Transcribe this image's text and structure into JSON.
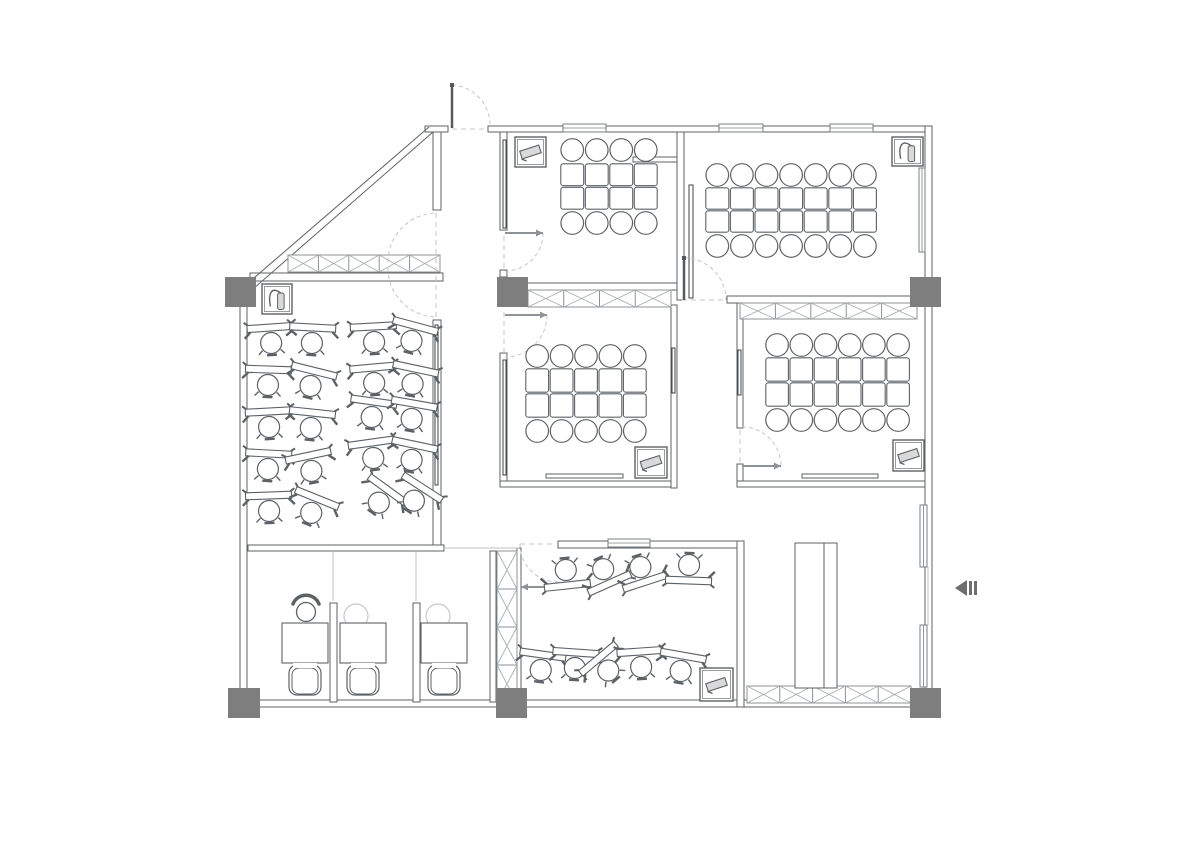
{
  "meta": {
    "drawing_type": "office-floor-plan",
    "canvas_w": 1200,
    "canvas_h": 848,
    "bg": "#ffffff"
  },
  "palette": {
    "wall": "#5d6166",
    "wall_fill": "#ffffff",
    "glass": "#3c4043",
    "window": "#7a7f84",
    "light": "#c2c2c2",
    "dash": "#c6c6c6",
    "leaf_light": "#8f9398",
    "leaf_dark": "#55585c",
    "casework": "#8d9196",
    "casework_x": "#a8adb2",
    "column": "#7e7e7e",
    "furniture": "#5d6166",
    "soft": "#c9c9c9",
    "arrow": "#6e6e6e",
    "equip_fill": "#d9d9d9"
  },
  "rooms_summary": [
    {
      "name": "meeting-room-top-left",
      "table": "4x2",
      "seats": 8,
      "equipment": [
        "tv-box",
        "wall-shelf"
      ]
    },
    {
      "name": "meeting-room-top-right",
      "table": "7x2",
      "seats": 14,
      "equipment": [
        "fire-extinguisher-box"
      ]
    },
    {
      "name": "meeting-room-mid-left",
      "table": "5x2",
      "seats": 10,
      "equipment": [
        "tv-box",
        "whiteboard"
      ]
    },
    {
      "name": "meeting-room-mid-right",
      "table": "6x2",
      "seats": 12,
      "equipment": [
        "tv-box",
        "whiteboard"
      ]
    },
    {
      "name": "training-room",
      "desk_units": 20,
      "rows": 5,
      "cols": 4
    },
    {
      "name": "offices",
      "workstations": 3,
      "equipment": [
        "phone",
        "monitors"
      ]
    },
    {
      "name": "computer-room",
      "desk_units": 9,
      "equipment": [
        "projector-box"
      ]
    },
    {
      "name": "vestibule",
      "equipment": [
        "casework",
        "fire-extinguisher-box"
      ]
    }
  ],
  "plan": {
    "walls": [
      [
        425,
        126,
        23,
        6
      ],
      [
        488,
        126,
        444,
        6
      ],
      [
        925,
        126,
        7,
        580
      ],
      [
        232,
        700,
        708,
        7
      ],
      [
        240,
        305,
        7,
        397
      ],
      [
        250,
        273,
        193,
        8
      ],
      [
        433,
        132,
        8,
        78
      ],
      [
        433,
        320,
        8,
        225
      ],
      [
        500,
        132,
        7,
        98
      ],
      [
        500,
        270,
        7,
        7
      ],
      [
        500,
        353,
        7,
        128
      ],
      [
        677,
        132,
        7,
        168
      ],
      [
        500,
        283,
        177,
        7
      ],
      [
        500,
        481,
        177,
        6
      ],
      [
        671,
        305,
        6,
        183
      ],
      [
        727,
        296,
        198,
        7
      ],
      [
        737,
        303,
        6,
        125
      ],
      [
        737,
        464,
        6,
        23
      ],
      [
        737,
        481,
        188,
        6
      ],
      [
        248,
        545,
        196,
        6
      ],
      [
        490,
        551,
        6,
        151
      ],
      [
        558,
        541,
        186,
        7
      ],
      [
        737,
        541,
        7,
        166
      ],
      [
        330,
        603,
        7,
        99
      ],
      [
        413,
        603,
        7,
        99
      ],
      [
        517,
        548,
        4,
        154
      ]
    ],
    "diagonals": [
      [
        247,
        284,
        429,
        127
      ],
      [
        253,
        289,
        433,
        132
      ]
    ],
    "glass": [
      [
        503,
        140,
        3,
        88
      ],
      [
        503,
        360,
        3,
        115
      ],
      [
        435,
        325,
        3,
        160
      ],
      [
        689,
        185,
        4,
        113
      ],
      [
        672,
        348,
        3,
        45
      ],
      [
        738,
        350,
        3,
        45
      ]
    ],
    "windows_h": [
      [
        563,
        124,
        43,
        8
      ],
      [
        719,
        124,
        44,
        8
      ],
      [
        830,
        124,
        43,
        8
      ],
      [
        608,
        539,
        42,
        8
      ]
    ],
    "windows_v": [
      [
        919,
        168,
        6,
        84
      ],
      [
        920,
        505,
        7,
        62
      ],
      [
        920,
        625,
        7,
        62
      ]
    ],
    "light_lines": [
      [
        333,
        551,
        333,
        601
      ],
      [
        416,
        551,
        416,
        601
      ],
      [
        444,
        548,
        519,
        548
      ],
      [
        928,
        567,
        928,
        625
      ]
    ],
    "casework": [
      [
        288,
        255,
        152,
        17,
        5,
        "h"
      ],
      [
        528,
        290,
        143,
        17,
        4,
        "h"
      ],
      [
        740,
        303,
        177,
        16,
        5,
        "h"
      ],
      [
        497,
        551,
        20,
        152,
        4,
        "v"
      ],
      [
        747,
        686,
        164,
        17,
        5,
        "h"
      ]
    ],
    "columns": [
      [
        225,
        277,
        31,
        30
      ],
      [
        497,
        277,
        31,
        30
      ],
      [
        910,
        277,
        31,
        30
      ],
      [
        228,
        688,
        32,
        30
      ],
      [
        496,
        688,
        31,
        30
      ],
      [
        910,
        688,
        31,
        30
      ]
    ],
    "whiteboards": [
      [
        546,
        474,
        77,
        4
      ],
      [
        802,
        474,
        76,
        4
      ],
      [
        633,
        157,
        44,
        5
      ]
    ],
    "dash_lines": [
      [
        436,
        213,
        436,
        318
      ],
      [
        504,
        236,
        504,
        268
      ],
      [
        504,
        312,
        504,
        352
      ],
      [
        682,
        300,
        727,
        300
      ],
      [
        520,
        544,
        556,
        544
      ],
      [
        740,
        430,
        740,
        462
      ],
      [
        452,
        129,
        488,
        129
      ]
    ],
    "door_arcs": [
      "M388 262 A49 49 0 0 1 437 213",
      "M388 268 A49 49 0 0 0 437 317",
      "M543 233 A38 38 0 0 1 505 271",
      "M547 315 A42 42 0 0 1 505 357",
      "M684 258 A42 42 0 0 1 726 300",
      "M742 427 A39 39 0 0 1 781 466",
      "M520 544 A38 38 0 0 0 558 582",
      "M452 85 A40 40 0 0 1 490 126"
    ],
    "door_leaves_light": [
      [
        505,
        233,
        543,
        233
      ],
      [
        505,
        315,
        547,
        315
      ],
      [
        742,
        466,
        781,
        466
      ],
      [
        558,
        587,
        521,
        587
      ]
    ],
    "door_leaves_dark": [
      [
        452,
        85,
        452,
        128
      ],
      [
        684,
        258,
        684,
        300
      ]
    ],
    "shaft": {
      "x": 795,
      "y": 543,
      "w": 42,
      "h": 145,
      "divider_x": 824
    },
    "tables": [
      {
        "x": 560,
        "y": 163,
        "cols": 4,
        "rows": 2,
        "cw": 24.5,
        "ch": 23.5,
        "chair_r": 11.3,
        "top_cy": 150,
        "bot_cy": 223
      },
      {
        "x": 705,
        "y": 187,
        "cols": 7,
        "rows": 2,
        "cw": 24.6,
        "ch": 23,
        "chair_r": 11.3,
        "top_cy": 175,
        "bot_cy": 246
      },
      {
        "x": 525,
        "y": 368,
        "cols": 5,
        "rows": 2,
        "cw": 24.4,
        "ch": 25,
        "chair_r": 11.3,
        "top_cy": 356,
        "bot_cy": 431
      },
      {
        "x": 765,
        "y": 357,
        "cols": 6,
        "rows": 2,
        "cw": 24.2,
        "ch": 25,
        "chair_r": 11.3,
        "top_cy": 345,
        "bot_cy": 420
      }
    ],
    "desks": [
      [
        271,
        341,
        -4,
        0
      ],
      [
        312,
        341,
        3,
        0
      ],
      [
        374,
        340,
        -3,
        0
      ],
      [
        412,
        339,
        15,
        0
      ],
      [
        268,
        383,
        2,
        0
      ],
      [
        311,
        384,
        14,
        0
      ],
      [
        374,
        381,
        -5,
        0
      ],
      [
        413,
        382,
        12,
        0
      ],
      [
        269,
        425,
        -3,
        0
      ],
      [
        311,
        426,
        6,
        0
      ],
      [
        372,
        415,
        8,
        0
      ],
      [
        412,
        417,
        10,
        0
      ],
      [
        268,
        467,
        3,
        0
      ],
      [
        311,
        469,
        -12,
        0
      ],
      [
        373,
        456,
        -8,
        0
      ],
      [
        412,
        458,
        12,
        0
      ],
      [
        269,
        509,
        -2,
        0
      ],
      [
        312,
        511,
        22,
        0
      ],
      [
        380,
        501,
        36,
        0
      ],
      [
        415,
        499,
        33,
        0
      ],
      [
        566,
        572,
        -6,
        1
      ],
      [
        604,
        571,
        -24,
        1
      ],
      [
        641,
        569,
        -18,
        1
      ],
      [
        689,
        567,
        2,
        1
      ],
      [
        541,
        668,
        8,
        0
      ],
      [
        575,
        666,
        4,
        0
      ],
      [
        607,
        669,
        -40,
        0
      ],
      [
        641,
        665,
        -4,
        0
      ],
      [
        681,
        669,
        10,
        0
      ]
    ],
    "office": {
      "desks": [
        [
          282,
          623,
          46,
          40
        ],
        [
          340,
          623,
          46,
          40
        ],
        [
          421,
          623,
          46,
          40
        ]
      ],
      "chairs": [
        [
          305,
          680
        ],
        [
          363,
          680
        ],
        [
          444,
          680
        ]
      ],
      "phone": [
        306,
        606
      ],
      "monitors": [
        [
          356,
          616,
          12
        ],
        [
          438,
          616,
          12
        ]
      ]
    },
    "boxes_tv": [
      [
        515,
        137,
        31,
        30
      ],
      [
        635,
        447,
        32,
        31
      ],
      [
        893,
        440,
        31,
        31
      ],
      [
        700,
        668,
        33,
        33
      ]
    ],
    "boxes_ext": [
      [
        262,
        284,
        30,
        30
      ],
      [
        892,
        137,
        31,
        29
      ]
    ],
    "entry_arrow": {
      "tri": [
        [
          955,
          588
        ],
        [
          967,
          580
        ],
        [
          967,
          596
        ]
      ],
      "bars": [
        [
          969,
          581,
          3,
          14
        ],
        [
          974,
          581,
          3,
          14
        ]
      ]
    }
  }
}
